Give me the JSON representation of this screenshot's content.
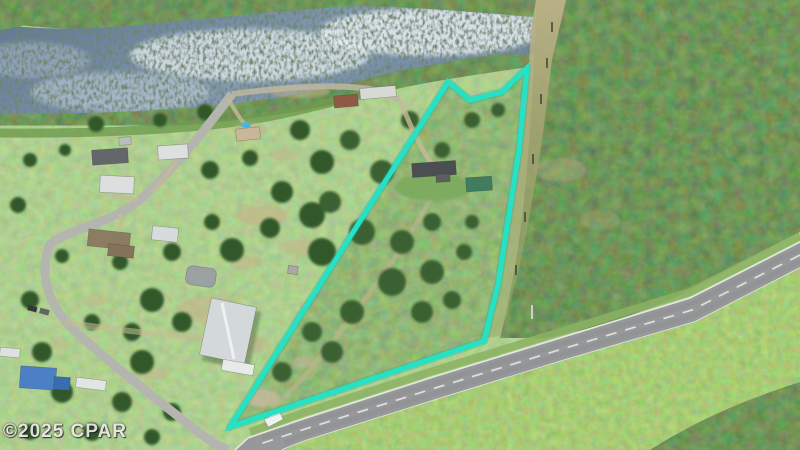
{
  "watermark": {
    "text": "©2025 CPAR"
  },
  "colors": {
    "boundary_line": "#23e2c6",
    "boundary_glow": "#0fae9b",
    "water": "#67809f",
    "water_highlight": "#e8edf1",
    "swamp_trees": "#24402a",
    "forest_dark": "#2e5128",
    "scrub_green": "#5f8a41",
    "field_green": "#7ca356",
    "young_forest": "#69a248",
    "road_asphalt": "#96989a",
    "road_marking": "#ebedec",
    "local_street": "#b4b5af",
    "sand_dirt": "#c6b28a",
    "metal_barn_roof": "#d3d8da",
    "quonset_barn_roof": "#9ba1a3",
    "green_barn_roof": "#3f7d5e",
    "red_house_roof": "#8e5a46",
    "dark_house_roof": "#4b4f51",
    "white_roof": "#dcdedf",
    "tarp_blue": "#4b80c4",
    "pool_blue": "#49b6d8",
    "powerline_corridor": "#b3a878"
  }
}
